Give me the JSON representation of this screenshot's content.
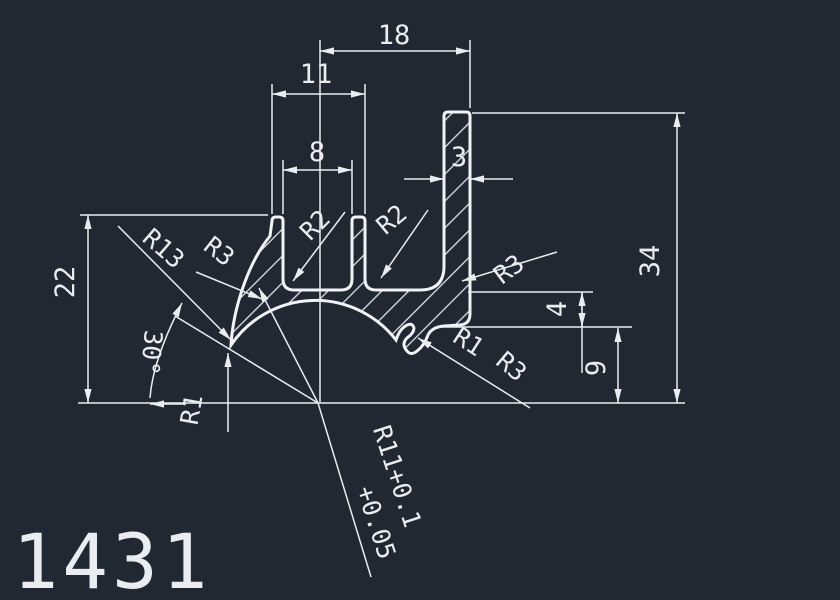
{
  "app": {
    "background": "#212831",
    "line_color": "#e9edf2"
  },
  "drawing": {
    "part_number": "1431",
    "linear_dimensions": {
      "top_outer": "18",
      "fingers_outer": "11",
      "slot_width": "8",
      "leg_thickness": "3",
      "left_height": "22",
      "right_height": "34",
      "web_gap": "4",
      "foot_height": "9"
    },
    "radius_labels": {
      "r13_outer_wall": "R13",
      "r3_left_wall": "R3",
      "r2_left_slot": "R2",
      "r2_right_slot": "R2",
      "r3_upper_right": "R3",
      "r1_notch": "R1",
      "r3_notch": "R3",
      "r1_tip": "R1"
    },
    "angle_label": "30°",
    "radius_tolerance": {
      "line1": "R11+0.1",
      "line2": "+0.05"
    }
  }
}
